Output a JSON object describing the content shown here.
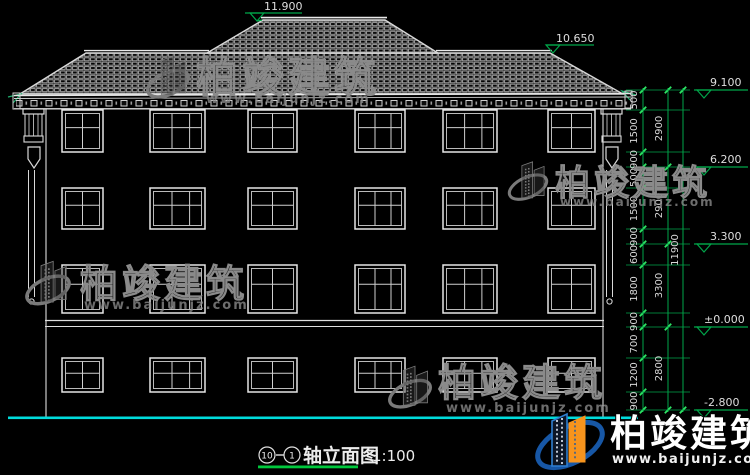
{
  "drawing": {
    "type": "building-elevation",
    "background": "#000000"
  },
  "elevation_markers": {
    "ridge": "11.900",
    "side_ridge": "10.650",
    "eave": "9.100",
    "floor3": "6.200",
    "floor2": "3.300",
    "ground_floor": "±0.000",
    "basement": "-2.800"
  },
  "dims": {
    "chain_small": [
      "500",
      "1500",
      "900",
      "500",
      "1500",
      "900",
      "600",
      "1800",
      "900",
      "700",
      "1200",
      "900"
    ],
    "chain_floor": [
      "2900",
      "2900",
      "3300",
      "2800"
    ],
    "total": "11900"
  },
  "watermark": {
    "title": "柏竣建筑",
    "url": "www.baijunjz.com"
  },
  "brand": {
    "title": "柏竣建筑",
    "url": "www.baijunjz.com"
  },
  "titleblock": {
    "axis_start": "10",
    "axis_end": "1",
    "name": "轴立面图",
    "scale": "1:100"
  },
  "colors": {
    "line_white": "#e6e6e6",
    "tile_gray": "#b4b4b4",
    "dim_green": "#00a64a",
    "tick_green": "#2ee564",
    "ground_cyan": "#00dcdc",
    "underline_green": "#00c83c",
    "brand_blue": "#1757a6",
    "brand_orange": "#f7941d"
  },
  "windows": {
    "cols": [
      {
        "x": 62,
        "w": 41,
        "panes": 2
      },
      {
        "x": 150,
        "w": 55,
        "panes": 3
      },
      {
        "x": 248,
        "w": 49,
        "panes": 2
      },
      {
        "x": 355,
        "w": 50,
        "panes": 3
      },
      {
        "x": 443,
        "w": 54,
        "panes": 3
      },
      {
        "x": 548,
        "w": 47,
        "panes": 2
      }
    ],
    "rows": [
      {
        "y": 110,
        "h": 42,
        "mull": 0.42
      },
      {
        "y": 188,
        "h": 41,
        "mull": 0.42
      },
      {
        "y": 265,
        "h": 48,
        "mull": 0.4
      },
      {
        "y": 358,
        "h": 34,
        "mull": 0.45
      }
    ]
  }
}
